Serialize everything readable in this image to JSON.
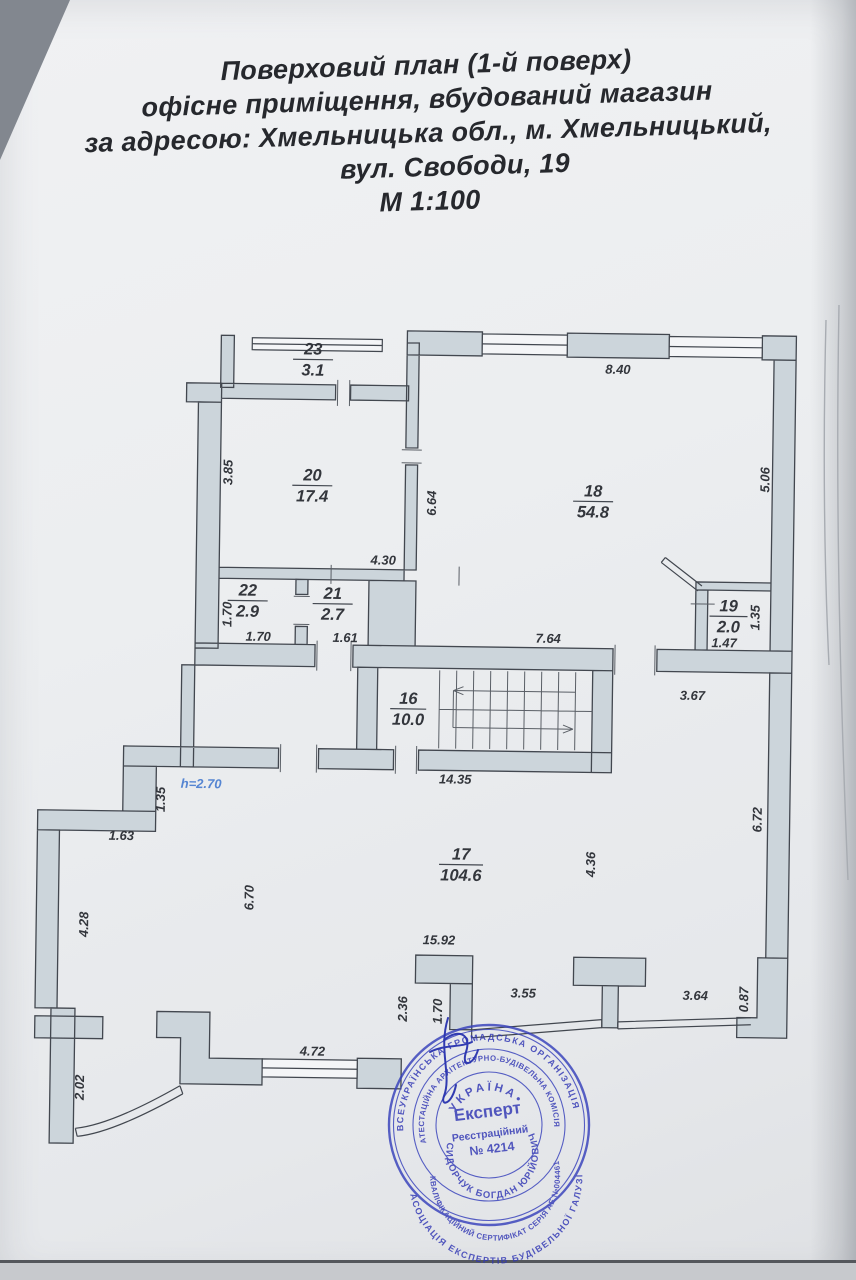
{
  "page": {
    "title_lines": [
      "Поверховий план (1-й поверх)",
      "офісне приміщення, вбудований магазин",
      "за адресою: Хмельницька обл., м. Хмельницький,",
      "вул. Свободи, 19",
      "М 1:100"
    ]
  },
  "plan": {
    "height_note": "h=2.70",
    "rooms": {
      "r23": {
        "num": "23",
        "area": "3.1"
      },
      "r20": {
        "num": "20",
        "area": "17.4"
      },
      "r18": {
        "num": "18",
        "area": "54.8"
      },
      "r22": {
        "num": "22",
        "area": "2.9"
      },
      "r21": {
        "num": "21",
        "area": "2.7"
      },
      "r19": {
        "num": "19",
        "area": "2.0"
      },
      "r16": {
        "num": "16",
        "area": "10.0"
      },
      "r17": {
        "num": "17",
        "area": "104.6"
      }
    },
    "dims": {
      "d840": "8.40",
      "d506": "5.06",
      "d385": "3.85",
      "d664": "6.64",
      "d430": "4.30",
      "d170a": "1.70",
      "d170b": "1.70",
      "d161": "1.61",
      "d764": "7.64",
      "d147": "1.47",
      "d135a": "1.35",
      "d367": "3.67",
      "d1435": "14.35",
      "d135b": "1.35",
      "d163": "1.63",
      "d428": "4.28",
      "d670": "6.70",
      "d436": "4.36",
      "d672": "6.72",
      "d1592": "15.92",
      "d236": "2.36",
      "d170c": "1.70",
      "d355": "3.55",
      "d364": "3.64",
      "d087": "0.87",
      "d202": "2.02",
      "d472": "4.72"
    }
  },
  "stamp": {
    "ring_outer_top": "ВСЕУКРАЇНСЬКА ГРОМАДСЬКА ОРГАНІЗАЦІЯ",
    "ring_outer_bottom": "АСОЦІАЦІЯ ЕКСПЕРТІВ БУДІВЕЛЬНОЇ ГАЛУЗІ",
    "ring_middle_top": "АТЕСТАЦІЙНА АРХІТЕКТУРНО-БУДІВЕЛЬНА КОМІСІЯ",
    "ring_middle_bottom": "КВАЛІФІКАЦІЙНИЙ СЕРТИФІКАТ СЕРІЯ АЕ №004461",
    "name": "СИДОРЧУК БОГДАН ЮРІЙОВИЧ",
    "country": "УКРАЇНА•",
    "role": "Експерт",
    "reg_label": "Реєстраційний",
    "reg_number": "№ 4214"
  }
}
